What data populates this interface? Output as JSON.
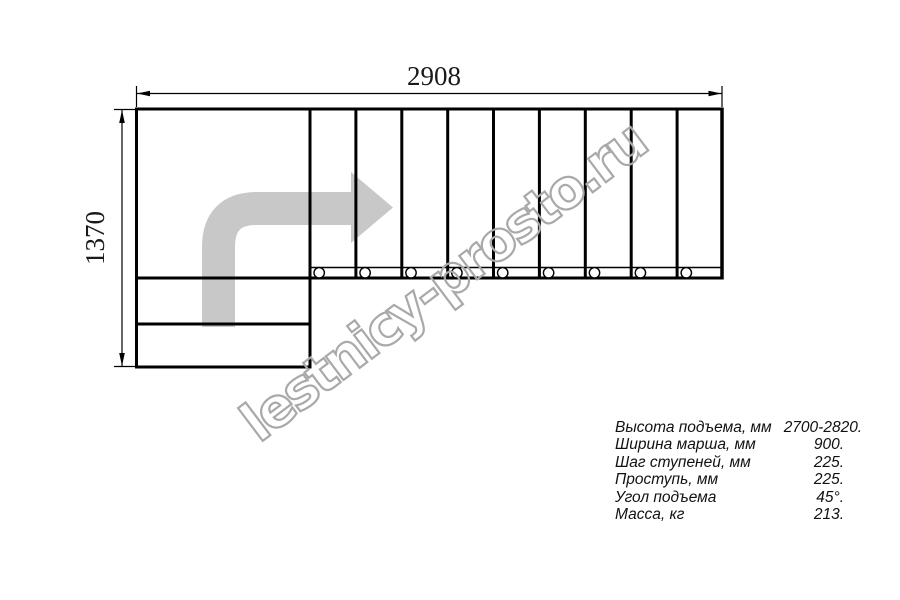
{
  "dimensions": {
    "width_label": "2908",
    "height_label": "1370"
  },
  "watermark": {
    "text": "lestnicy-prosto.ru"
  },
  "specs": {
    "rows": [
      {
        "label": "Высота подъема, мм",
        "value": "2700-2820."
      },
      {
        "label": "Ширина марша, мм",
        "value": "900."
      },
      {
        "label": "Шаг ступеней, мм",
        "value": "225."
      },
      {
        "label": "Проступь, мм",
        "value": "225."
      },
      {
        "label": "Угол подъема",
        "value": "45°."
      },
      {
        "label": "Масса, кг",
        "value": "213."
      }
    ]
  },
  "colors": {
    "line": "#000000",
    "direction_arrow_gray": "#c8c8c8",
    "watermark_gray": "#a9a9a9"
  }
}
